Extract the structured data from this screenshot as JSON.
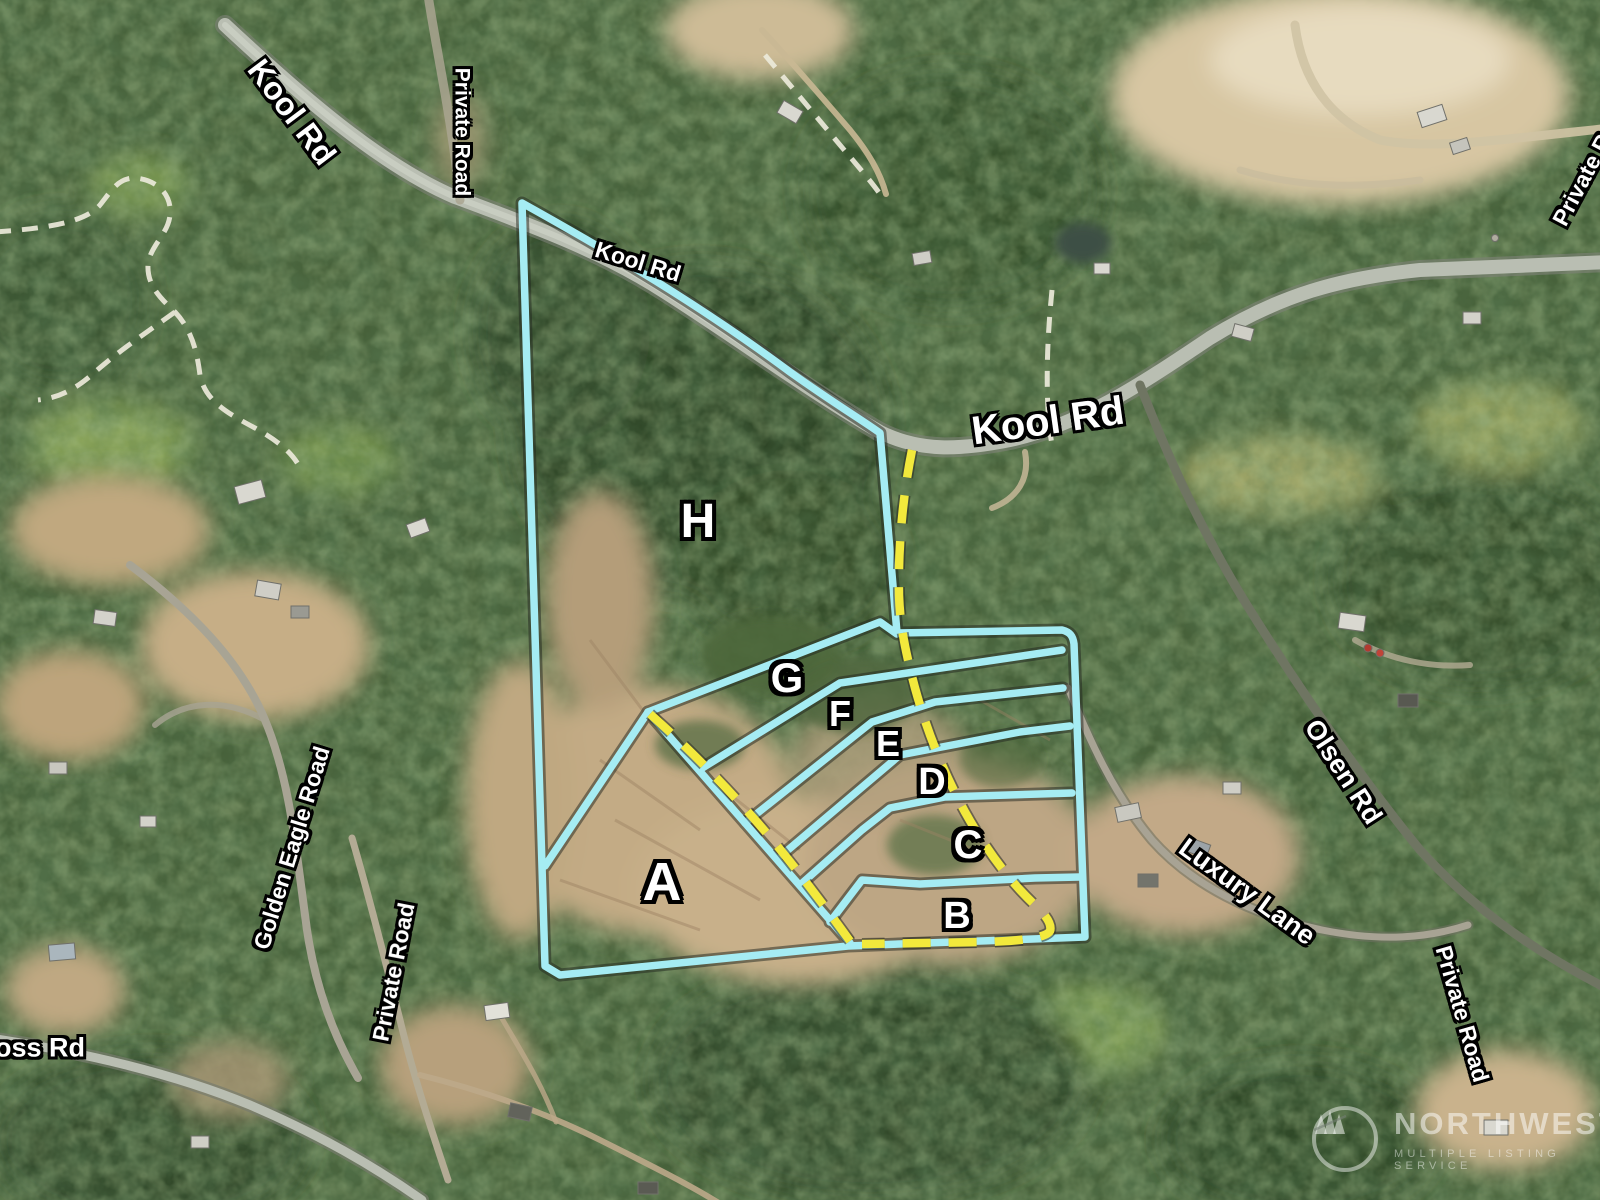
{
  "map": {
    "description": "Aerial parcel map with lot outlines",
    "road_labels": [
      {
        "id": "kool-rd-topleft",
        "text": "Kool Rd"
      },
      {
        "id": "private-road-topleft",
        "text": "Private Road"
      },
      {
        "id": "kool-rd-center",
        "text": "Kool Rd"
      },
      {
        "id": "kool-rd-main",
        "text": "Kool Rd"
      },
      {
        "id": "private-road-topright",
        "text": "Private Road"
      },
      {
        "id": "olsen-rd",
        "text": "Olsen Rd"
      },
      {
        "id": "luxury-lane",
        "text": "Luxury Lane"
      },
      {
        "id": "private-road-bottomright",
        "text": "Private Road"
      },
      {
        "id": "golden-eagle-road",
        "text": "Golden Eagle Road"
      },
      {
        "id": "private-road-left",
        "text": "Private Road"
      },
      {
        "id": "ross-rd",
        "text": "oss Rd"
      }
    ],
    "lot_labels": [
      {
        "id": "lot-a",
        "text": "A"
      },
      {
        "id": "lot-b",
        "text": "B"
      },
      {
        "id": "lot-c",
        "text": "C"
      },
      {
        "id": "lot-d",
        "text": "D"
      },
      {
        "id": "lot-e",
        "text": "E"
      },
      {
        "id": "lot-f",
        "text": "F"
      },
      {
        "id": "lot-g",
        "text": "G"
      },
      {
        "id": "lot-h",
        "text": "H"
      }
    ],
    "colors": {
      "boundary_cyan": "#a5ecf3",
      "access_road_yellow": "#f2e93c",
      "road_gray": "#b9beb2",
      "forest_green": "#47613a",
      "cleared_tan": "#c3ab85",
      "label_white": "#ffffff"
    }
  },
  "watermark": {
    "name": "NORTHWEST",
    "tagline": "MULTIPLE LISTING SERVICE",
    "logo": "three-pines-circle"
  }
}
